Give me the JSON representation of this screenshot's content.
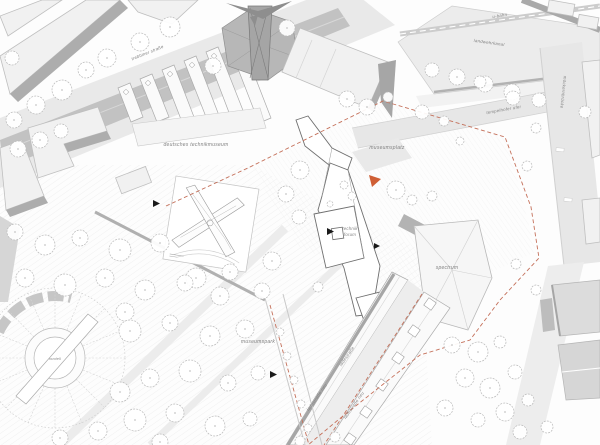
{
  "drawing": {
    "type": "architectural site plan",
    "labels": {
      "trebbiner_strasse": "trebbiner straße",
      "deutsches_technikmuseum": "deutsches technikmuseum",
      "u_bahn": "u-bahn",
      "landwehrkanal": "landwehrkanal",
      "tempelhofer_ufer": "tempelhofer ufer",
      "moeckernbruecke": "möckernbrücke",
      "museumsplatz": "museumsplatz",
      "technik": "technik",
      "forum": "forum",
      "spectrum": "spectrum",
      "museumspark": "museumspark",
      "ladestrasse": "ladestraße",
      "ladestrasse_neu": "ladestraße neu",
      "ladestrasse_neu_2": "ladestraße neu",
      "rondell": "rondell"
    },
    "colors": {
      "paper": "#fdfdfd",
      "road": "#c2c2c2",
      "building_light": "#f1f1f1",
      "building_dark": "#b7b7b7",
      "site_boundary": "#c4705a",
      "entrance_arrow": "#cf5f35",
      "label_gray": "#828282"
    }
  }
}
